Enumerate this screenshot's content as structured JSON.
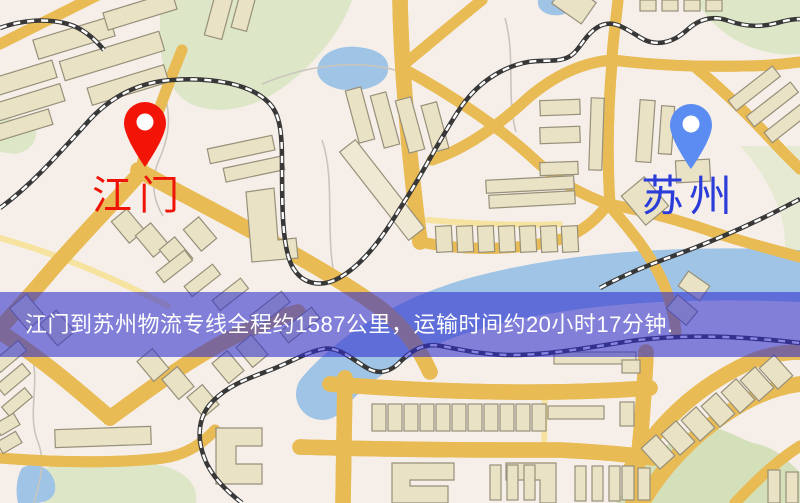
{
  "map": {
    "origin_marker": {
      "label": "江门",
      "label_color": "#ee1408",
      "pin_color": "#f31408"
    },
    "destination_marker": {
      "label": "苏州",
      "label_color": "#2b3cd8",
      "pin_color": "#5a8cf2"
    },
    "banner": {
      "text": "江门到苏州物流专线全程约1587公里，运输时间约20小时17分钟.",
      "overlay_color": "rgba(47,47,205,0.58)",
      "text_color": "#ffffff"
    },
    "route": {
      "origin": "江门",
      "destination": "苏州",
      "distance_text": "约1587公里",
      "duration_text": "约20小时17分钟"
    }
  }
}
